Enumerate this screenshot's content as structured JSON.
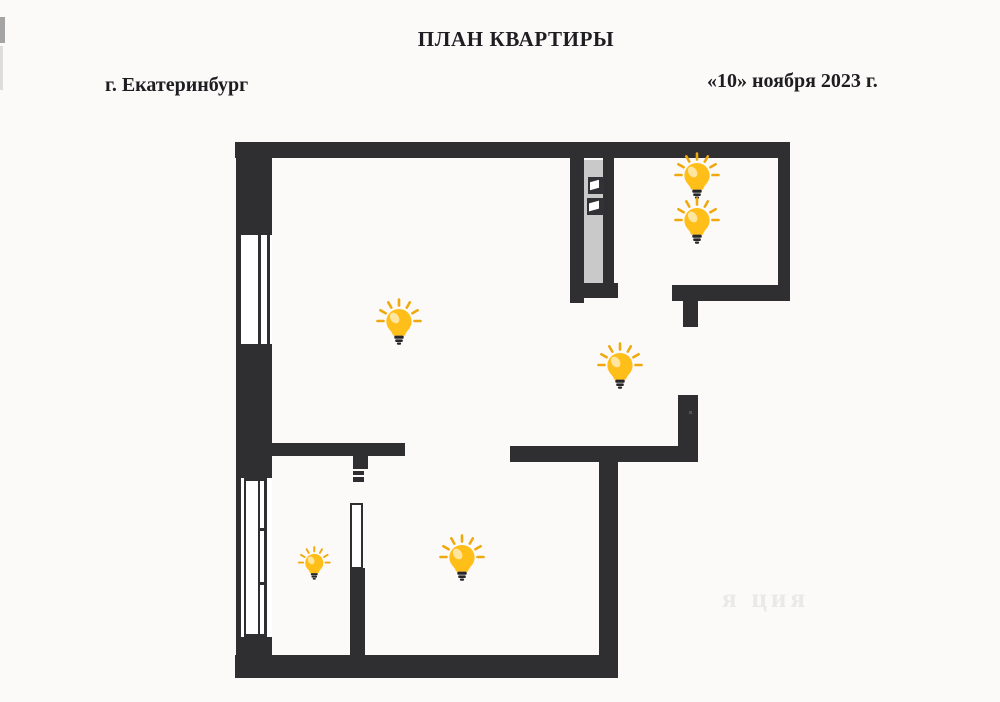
{
  "header": {
    "title": "ПЛАН КВАРТИРЫ",
    "city": "г. Екатеринбург",
    "date": "«10» ноября 2023 г."
  },
  "watermark": {
    "text": "я ция"
  },
  "colors": {
    "paper": "#fbfaf8",
    "wall": "#2f2f32",
    "shaft_fill": "#c9c9c9",
    "panel": "#323236",
    "bulb_body": "#ffbe18",
    "bulb_highlight": "#ffe8a8",
    "bulb_rays": "#efa90f",
    "bulb_base": "#27272a",
    "watermark_color": "#dcd9d5"
  },
  "plan": {
    "walls": [
      {
        "name": "top-wall",
        "x": 235,
        "y": 142,
        "w": 555,
        "h": 16
      },
      {
        "name": "right-wall",
        "x": 778,
        "y": 142,
        "w": 12,
        "h": 159
      },
      {
        "name": "kitchen-bottom-wall",
        "x": 672,
        "y": 285,
        "w": 118,
        "h": 16
      },
      {
        "name": "kitchen-door-stub",
        "x": 683,
        "y": 301,
        "w": 15,
        "h": 26
      },
      {
        "name": "hallway-right-wall",
        "x": 678,
        "y": 395,
        "w": 20,
        "h": 67
      },
      {
        "name": "hallway-bottom-wall",
        "x": 510,
        "y": 446,
        "w": 188,
        "h": 16
      },
      {
        "name": "bedroom-right-wall",
        "x": 599,
        "y": 462,
        "w": 19,
        "h": 216
      },
      {
        "name": "bottom-wall",
        "x": 235,
        "y": 655,
        "w": 383,
        "h": 23
      },
      {
        "name": "left-outer-line",
        "x": 236,
        "y": 142,
        "w": 5,
        "h": 536
      },
      {
        "name": "left-wall-upper",
        "x": 236,
        "y": 142,
        "w": 36,
        "h": 93
      },
      {
        "name": "left-wall-middle",
        "x": 241,
        "y": 344,
        "w": 31,
        "h": 134
      },
      {
        "name": "left-wall-lower",
        "x": 241,
        "y": 637,
        "w": 31,
        "h": 41
      },
      {
        "name": "living-room-south-wall",
        "x": 272,
        "y": 443,
        "w": 133,
        "h": 13
      },
      {
        "name": "closet-door-stub",
        "x": 353,
        "y": 456,
        "w": 15,
        "h": 13
      },
      {
        "name": "closet-door-jamb-a",
        "x": 353,
        "y": 471,
        "w": 11,
        "h": 4
      },
      {
        "name": "closet-door-jamb-b",
        "x": 353,
        "y": 477,
        "w": 11,
        "h": 5
      },
      {
        "name": "closet-east-wall",
        "x": 350,
        "y": 568,
        "w": 15,
        "h": 87
      },
      {
        "name": "shaft-west-wall",
        "x": 570,
        "y": 158,
        "w": 14,
        "h": 145
      },
      {
        "name": "shaft-east-wall",
        "x": 603,
        "y": 158,
        "w": 11,
        "h": 137
      },
      {
        "name": "shaft-south-wall",
        "x": 570,
        "y": 283,
        "w": 48,
        "h": 15
      }
    ],
    "shaft": {
      "fill": {
        "name": "shaft-duct",
        "x": 584,
        "y": 160,
        "w": 19,
        "h": 123
      },
      "panels": [
        {
          "name": "shaft-panel-1",
          "x": 588,
          "y": 177,
          "w": 16,
          "h": 17
        },
        {
          "name": "shaft-panel-2",
          "x": 587,
          "y": 198,
          "w": 17,
          "h": 17
        }
      ]
    },
    "windows": [
      {
        "name": "living-room-window",
        "x": 241,
        "y": 235,
        "w": 31,
        "h": 109,
        "style": "double"
      },
      {
        "name": "balcony-window",
        "x": 241,
        "y": 478,
        "w": 31,
        "h": 159,
        "style": "framed"
      }
    ],
    "door_leaf": {
      "name": "closet-door-leaf",
      "x": 350,
      "y": 503,
      "w": 13,
      "h": 66
    },
    "lights": [
      {
        "name": "living-room-light",
        "cx": 399,
        "cy": 322,
        "s": 1
      },
      {
        "name": "kitchen-light-1",
        "cx": 697,
        "cy": 176,
        "s": 1
      },
      {
        "name": "kitchen-light-2",
        "cx": 697,
        "cy": 221,
        "s": 1
      },
      {
        "name": "hallway-light",
        "cx": 620,
        "cy": 366,
        "s": 1
      },
      {
        "name": "bedroom-light",
        "cx": 462,
        "cy": 558,
        "s": 1
      },
      {
        "name": "closet-light",
        "cx": 314,
        "cy": 563,
        "s": 0.72
      }
    ]
  },
  "artifacts": [
    {
      "name": "scan-mark-1",
      "x": 0,
      "y": 17,
      "w": 5,
      "h": 26,
      "color": "#8e8e8e",
      "opacity": 0.8
    },
    {
      "name": "scan-mark-2",
      "x": 0,
      "y": 46,
      "w": 3,
      "h": 44,
      "color": "#c9c9c9",
      "opacity": 0.6
    },
    {
      "name": "scan-speck",
      "x": 689,
      "y": 411,
      "w": 3,
      "h": 3,
      "color": "#55555a",
      "opacity": 0.9
    }
  ]
}
